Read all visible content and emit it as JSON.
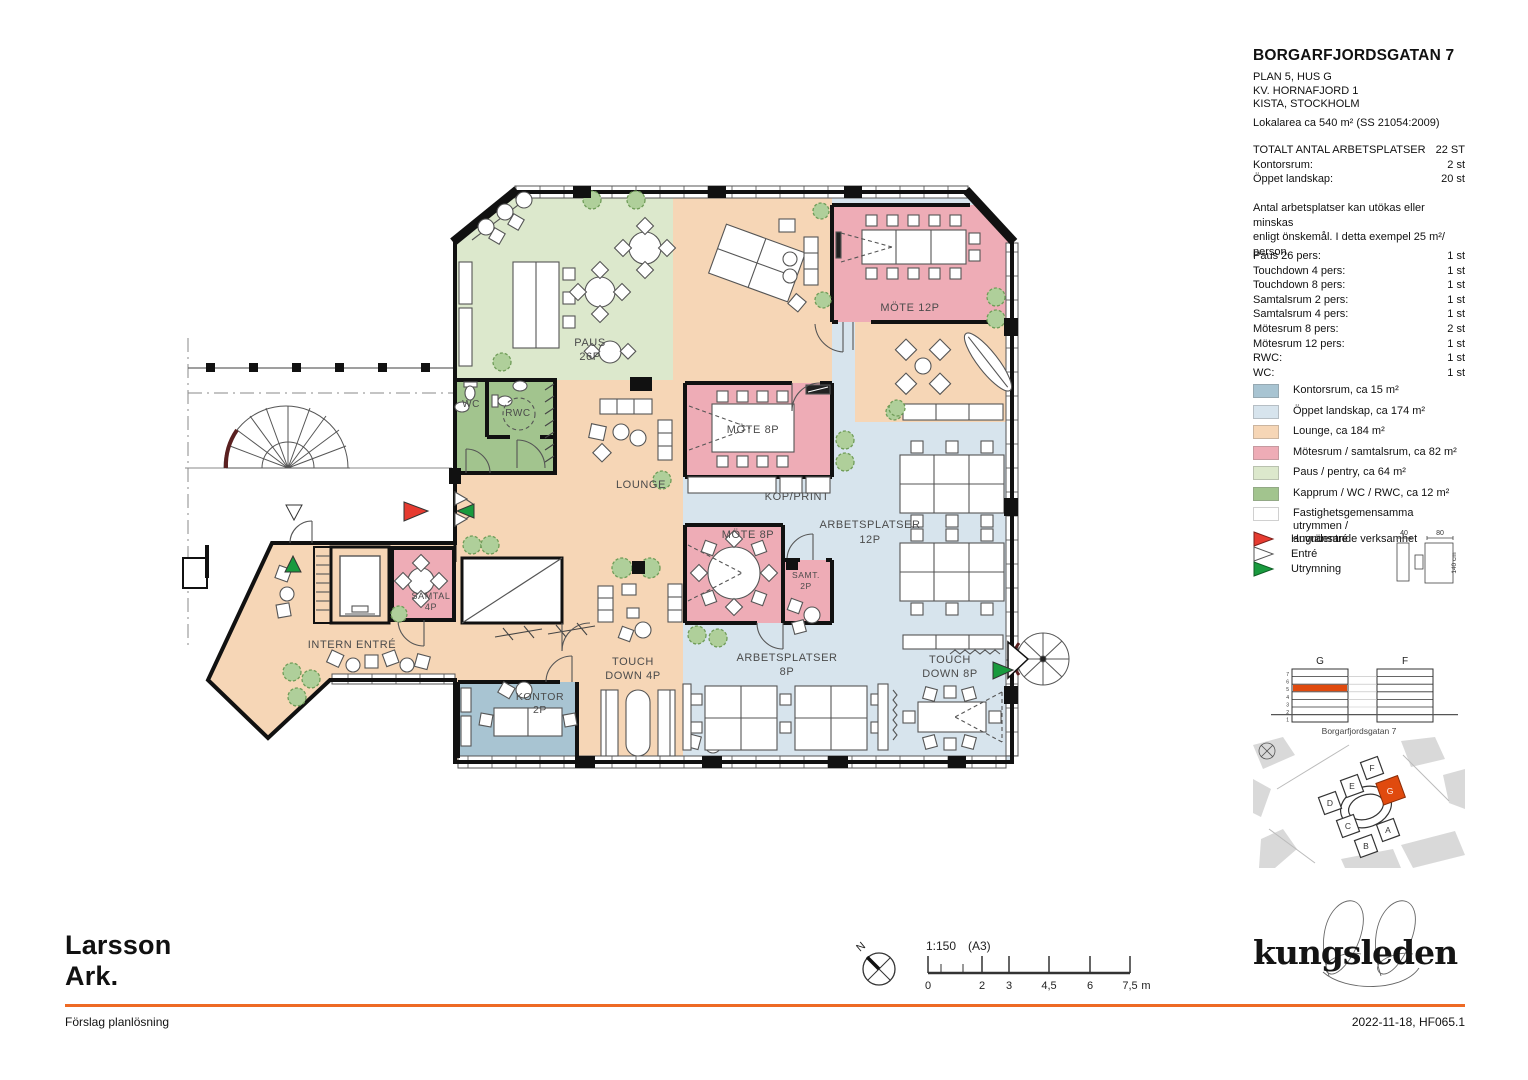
{
  "title_block": {
    "title": "BORGARFJORDSGATAN 7",
    "address_lines": [
      "PLAN 5, HUS G",
      "KV. HORNAFJORD 1",
      "KISTA, STOCKHOLM"
    ],
    "area": "Lokalarea ca 540 m² (SS 21054:2009)"
  },
  "totals": {
    "label": "TOTALT ANTAL ARBETSPLATSER",
    "value": "22 ST",
    "rows": [
      {
        "label": "Kontorsrum:",
        "value": "2 st"
      },
      {
        "label": "Öppet landskap:",
        "value": "20 st"
      }
    ]
  },
  "note_lines": [
    "Antal arbetsplatser kan utökas eller minskas",
    "enligt önskemål. I detta exempel 25 m²/ person."
  ],
  "room_counts": [
    {
      "label": "Paus 26 pers:",
      "value": "1 st"
    },
    {
      "label": "Touchdown 4 pers:",
      "value": "1 st"
    },
    {
      "label": "Touchdown 8 pers:",
      "value": "1 st"
    },
    {
      "label": "Samtalsrum 2 pers:",
      "value": "1 st"
    },
    {
      "label": "Samtalsrum 4 pers:",
      "value": "1 st"
    },
    {
      "label": "Mötesrum 8 pers:",
      "value": "2 st"
    },
    {
      "label": "Mötesrum 12 pers:",
      "value": "1 st"
    },
    {
      "label": "RWC:",
      "value": "1 st"
    },
    {
      "label": "WC:",
      "value": "1 st"
    }
  ],
  "legend": [
    {
      "label": "Kontorsrum, ca 15 m²",
      "color": "#a8c4d2"
    },
    {
      "label": "Öppet landskap, ca 174 m²",
      "color": "#d7e4ed"
    },
    {
      "label": "Lounge, ca 184 m²",
      "color": "#f6d6b6"
    },
    {
      "label": "Mötesrum / samtalsrum, ca 82 m²",
      "color": "#eeacb6"
    },
    {
      "label": "Paus / pentry, ca 64 m²",
      "color": "#dce8cc"
    },
    {
      "label": "Kapprum / WC / RWC, ca 12 m²",
      "color": "#a2c48e"
    },
    {
      "label": "Fastighetsgemensamma utrymmen /\nangränsande verksamhet",
      "color": "#ffffff"
    }
  ],
  "entries": [
    {
      "label": "Huvudentré",
      "color": "#e63b30"
    },
    {
      "label": "Entré",
      "color": "#ffffff"
    },
    {
      "label": "Utrymning",
      "color": "#199a3e"
    }
  ],
  "furniture_dims": {
    "d1": "40",
    "d2": "80",
    "d3": "140 cm"
  },
  "building_diagram": {
    "tower_left": "G",
    "tower_right": "F",
    "floor_numbers": [
      "7",
      "6",
      "5",
      "4",
      "3",
      "2",
      "1"
    ],
    "caption": "Borgarfjordsgatan 7",
    "highlight_color": "#e04a0e"
  },
  "site_map": {
    "a": "A",
    "b": "B",
    "c": "C",
    "d": "D",
    "e": "E",
    "f": "F",
    "g": "G"
  },
  "plan_labels": {
    "paus1": "PAUS",
    "paus2": "26P",
    "mote12": "MÖTE 12P",
    "wc": "WC",
    "rwc": "RWC",
    "lounge": "LOUNGE",
    "mote8_top": "MÖTE 8P",
    "kop": "KOP/PRINT",
    "arb12_1": "ARBETSPLATSER",
    "arb12_2": "12P",
    "mote8_low": "MÖTE 8P",
    "samt2_1": "SAMT.",
    "samt2_2": "2P",
    "samtal4_1": "SAMTAL",
    "samtal4_2": "4P",
    "intern": "INTERN ENTRÉ",
    "kontor1": "KONTOR",
    "kontor2": "2P",
    "td4_1": "TOUCH",
    "td4_2": "DOWN 4P",
    "arb8_1": "ARBETSPLATSER",
    "arb8_2": "8P",
    "td8_1": "TOUCH",
    "td8_2": "DOWN 8P"
  },
  "scale_bar": {
    "ratio": "1:150",
    "paper": "(A3)",
    "labels": [
      "0",
      "2",
      "3",
      "4,5",
      "6",
      "7,5"
    ],
    "unit": "m"
  },
  "compass": {
    "label": "N"
  },
  "brand": {
    "architect_line1": "Larsson",
    "architect_line2": "Ark.",
    "logo": "kungsleden"
  },
  "footer": {
    "left": "Förslag planlösning",
    "right": "2022-11-18, HF065.1"
  },
  "colors": {
    "accent": "#ee6a24",
    "highlight": "#e04a0e"
  }
}
